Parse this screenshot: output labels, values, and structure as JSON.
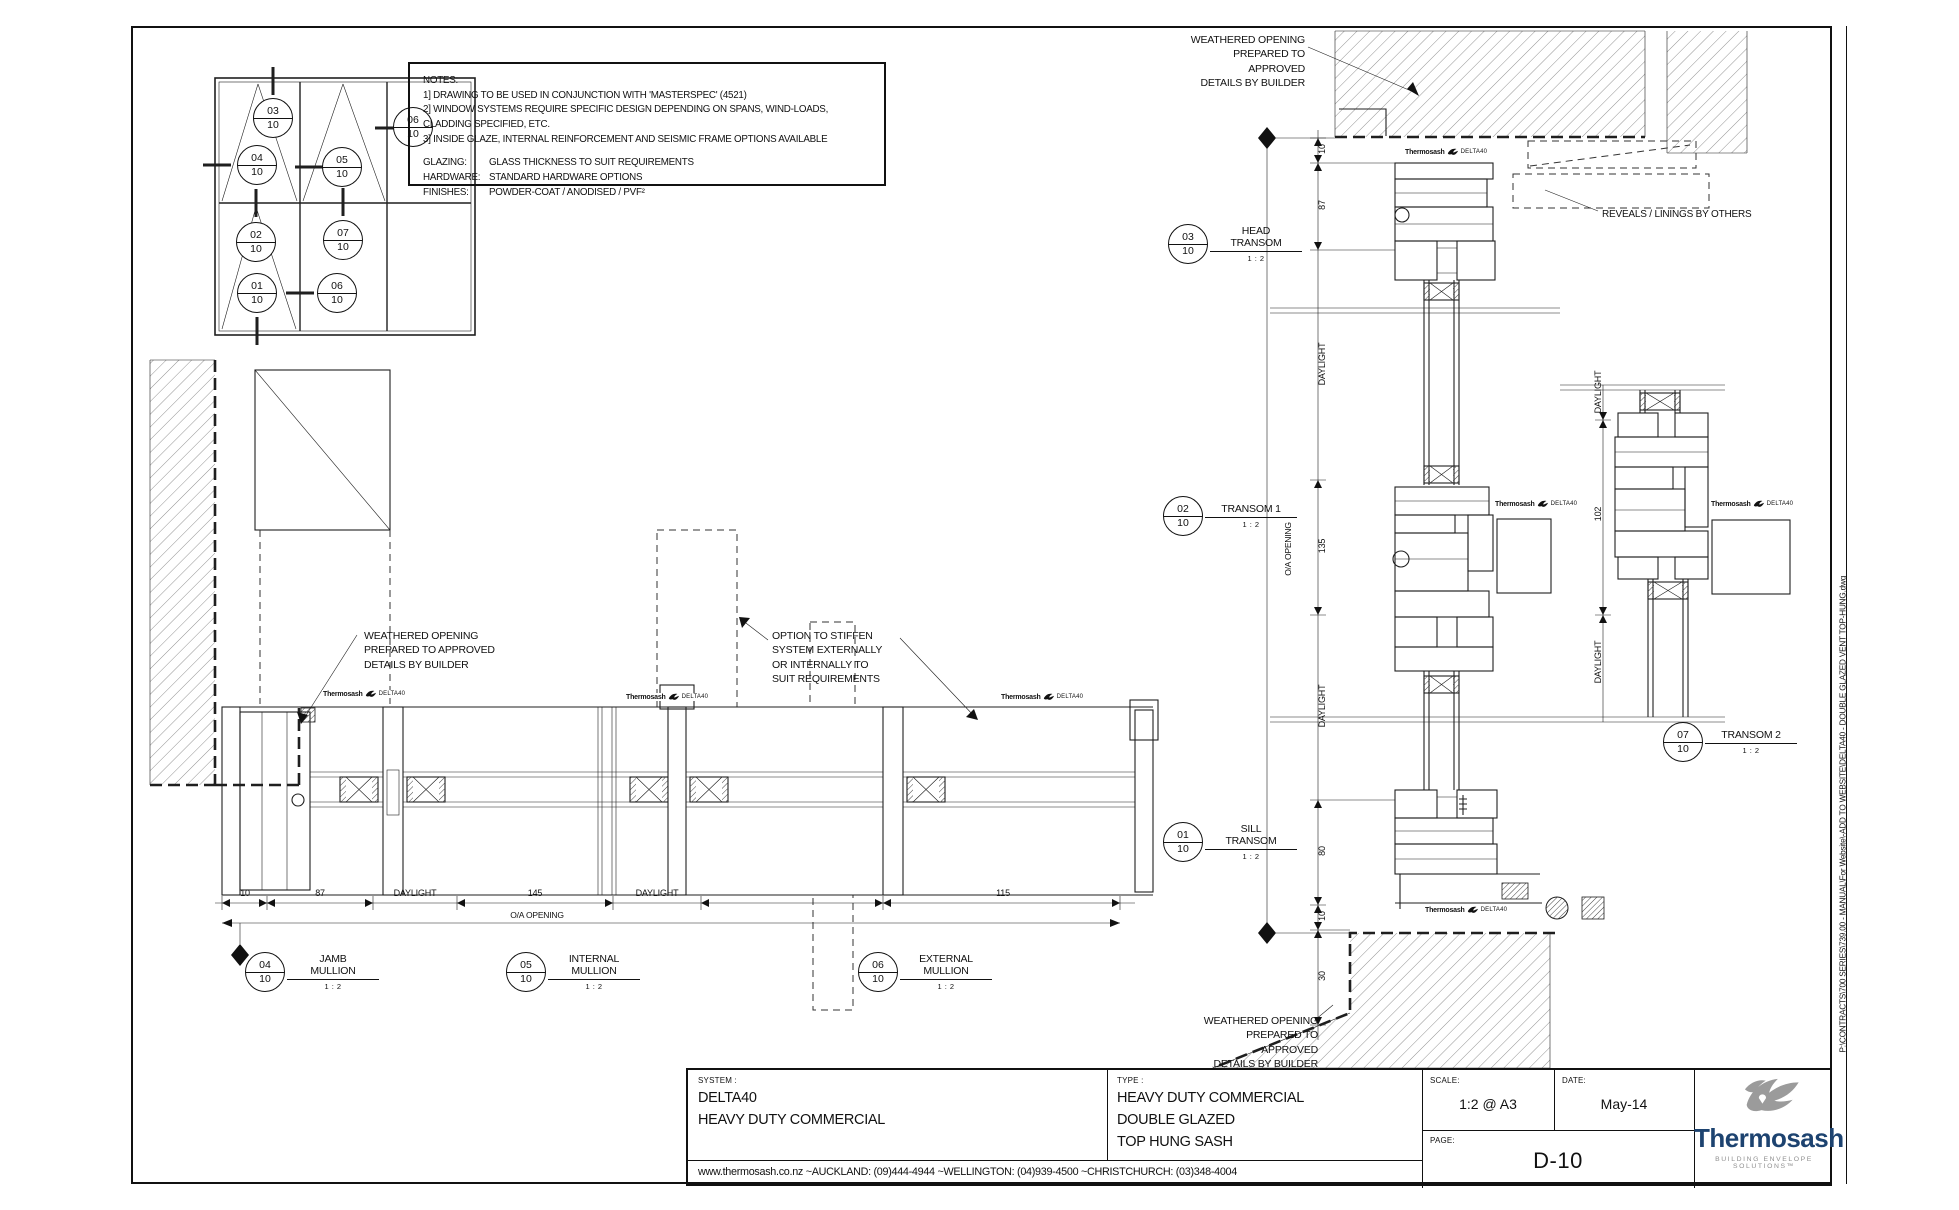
{
  "sheet": {
    "background": "#ffffff",
    "line_color": "#1f1f1f"
  },
  "elevation": {
    "callouts": [
      {
        "num": "03",
        "den": "10"
      },
      {
        "num": "04",
        "den": "10"
      },
      {
        "num": "05",
        "den": "10"
      },
      {
        "num": "06",
        "den": "10"
      },
      {
        "num": "02",
        "den": "10"
      },
      {
        "num": "07",
        "den": "10"
      },
      {
        "num": "01",
        "den": "10"
      },
      {
        "num": "06",
        "den": "10"
      }
    ]
  },
  "notes": {
    "title": "NOTES:",
    "line1": "1] DRAWING TO BE USED IN CONJUNCTION WITH 'MASTERSPEC' (4521)",
    "line2": "2] WINDOW SYSTEMS REQUIRE SPECIFIC DESIGN DEPENDING ON SPANS, WIND-LOADS, CLADDING SPECIFIED, ETC.",
    "line3": "3] INSIDE GLAZE, INTERNAL REINFORCEMENT AND SEISMIC FRAME OPTIONS AVAILABLE",
    "glazing_label": "GLAZING:",
    "glazing_value": "GLASS THICKNESS TO SUIT REQUIREMENTS",
    "hardware_label": "HARDWARE:",
    "hardware_value": "STANDARD HARDWARE OPTIONS",
    "finishes_label": "FINISHES:",
    "finishes_value": "POWDER-COAT / ANODISED / PVF²"
  },
  "annotations": {
    "weathered": "WEATHERED OPENING\nPREPARED TO APPROVED\nDETAILS BY BUILDER",
    "reveals": "REVEALS / LININGS BY OTHERS",
    "option": "OPTION TO STIFFEN\nSYSTEM EXTERNALLY\nOR INTERNALLY TO\nSUIT REQUIREMENTS"
  },
  "details": {
    "head": {
      "num": "03",
      "den": "10",
      "title": "HEAD\nTRANSOM",
      "scale": "1 : 2"
    },
    "transom1": {
      "num": "02",
      "den": "10",
      "title": "TRANSOM 1",
      "scale": "1 : 2"
    },
    "sill": {
      "num": "01",
      "den": "10",
      "title": "SILL\nTRANSOM",
      "scale": "1 : 2"
    },
    "transom2": {
      "num": "07",
      "den": "10",
      "title": "TRANSOM 2",
      "scale": "1 : 2"
    },
    "jamb": {
      "num": "04",
      "den": "10",
      "title": "JAMB\nMULLION",
      "scale": "1 : 2"
    },
    "internal": {
      "num": "05",
      "den": "10",
      "title": "INTERNAL\nMULLION",
      "scale": "1 : 2"
    },
    "external": {
      "num": "06",
      "den": "10",
      "title": "EXTERNAL\nMULLION",
      "scale": "1 : 2"
    }
  },
  "dims": {
    "v": [
      "10",
      "87",
      "DAYLIGHT",
      "135",
      "DAYLIGHT",
      "80",
      "10",
      "30"
    ],
    "v_right": [
      "DAYLIGHT",
      "102",
      "DAYLIGHT"
    ],
    "h": [
      "10",
      "87",
      "DAYLIGHT",
      "145",
      "DAYLIGHT",
      "115"
    ],
    "oa": "O/A OPENING"
  },
  "brand": {
    "name": "Thermosash",
    "model": "DELTA40"
  },
  "title_block": {
    "system_label": "SYSTEM :",
    "system_line1": "DELTA40",
    "system_line2": "HEAVY DUTY COMMERCIAL",
    "type_label": "TYPE :",
    "type_line1": "HEAVY DUTY COMMERCIAL",
    "type_line2": "DOUBLE GLAZED",
    "type_line3": "TOP HUNG SASH",
    "scale_label": "SCALE:",
    "scale_value": "1:2 @ A3",
    "date_label": "DATE:",
    "date_value": "May-14",
    "page_label": "PAGE:",
    "page_value": "D-10",
    "website": "www.thermosash.co.nz ~AUCKLAND: (09)444-4944 ~WELLINGTON: (04)939-4500 ~CHRISTCHURCH: (03)348-4004",
    "logo_name": "Thermosash",
    "logo_tagline": "BUILDING ENVELOPE SOLUTIONS™",
    "logo_color": "#1d4370"
  },
  "file_path": "P:\\CONTRACTS\\700 SERIES\\739.00 - MANUAL\\For Website\\-ADD TO WEBSITE\\DELTA40 - DOUBLE GLAZED VENT TOP-HUNG.dwg"
}
